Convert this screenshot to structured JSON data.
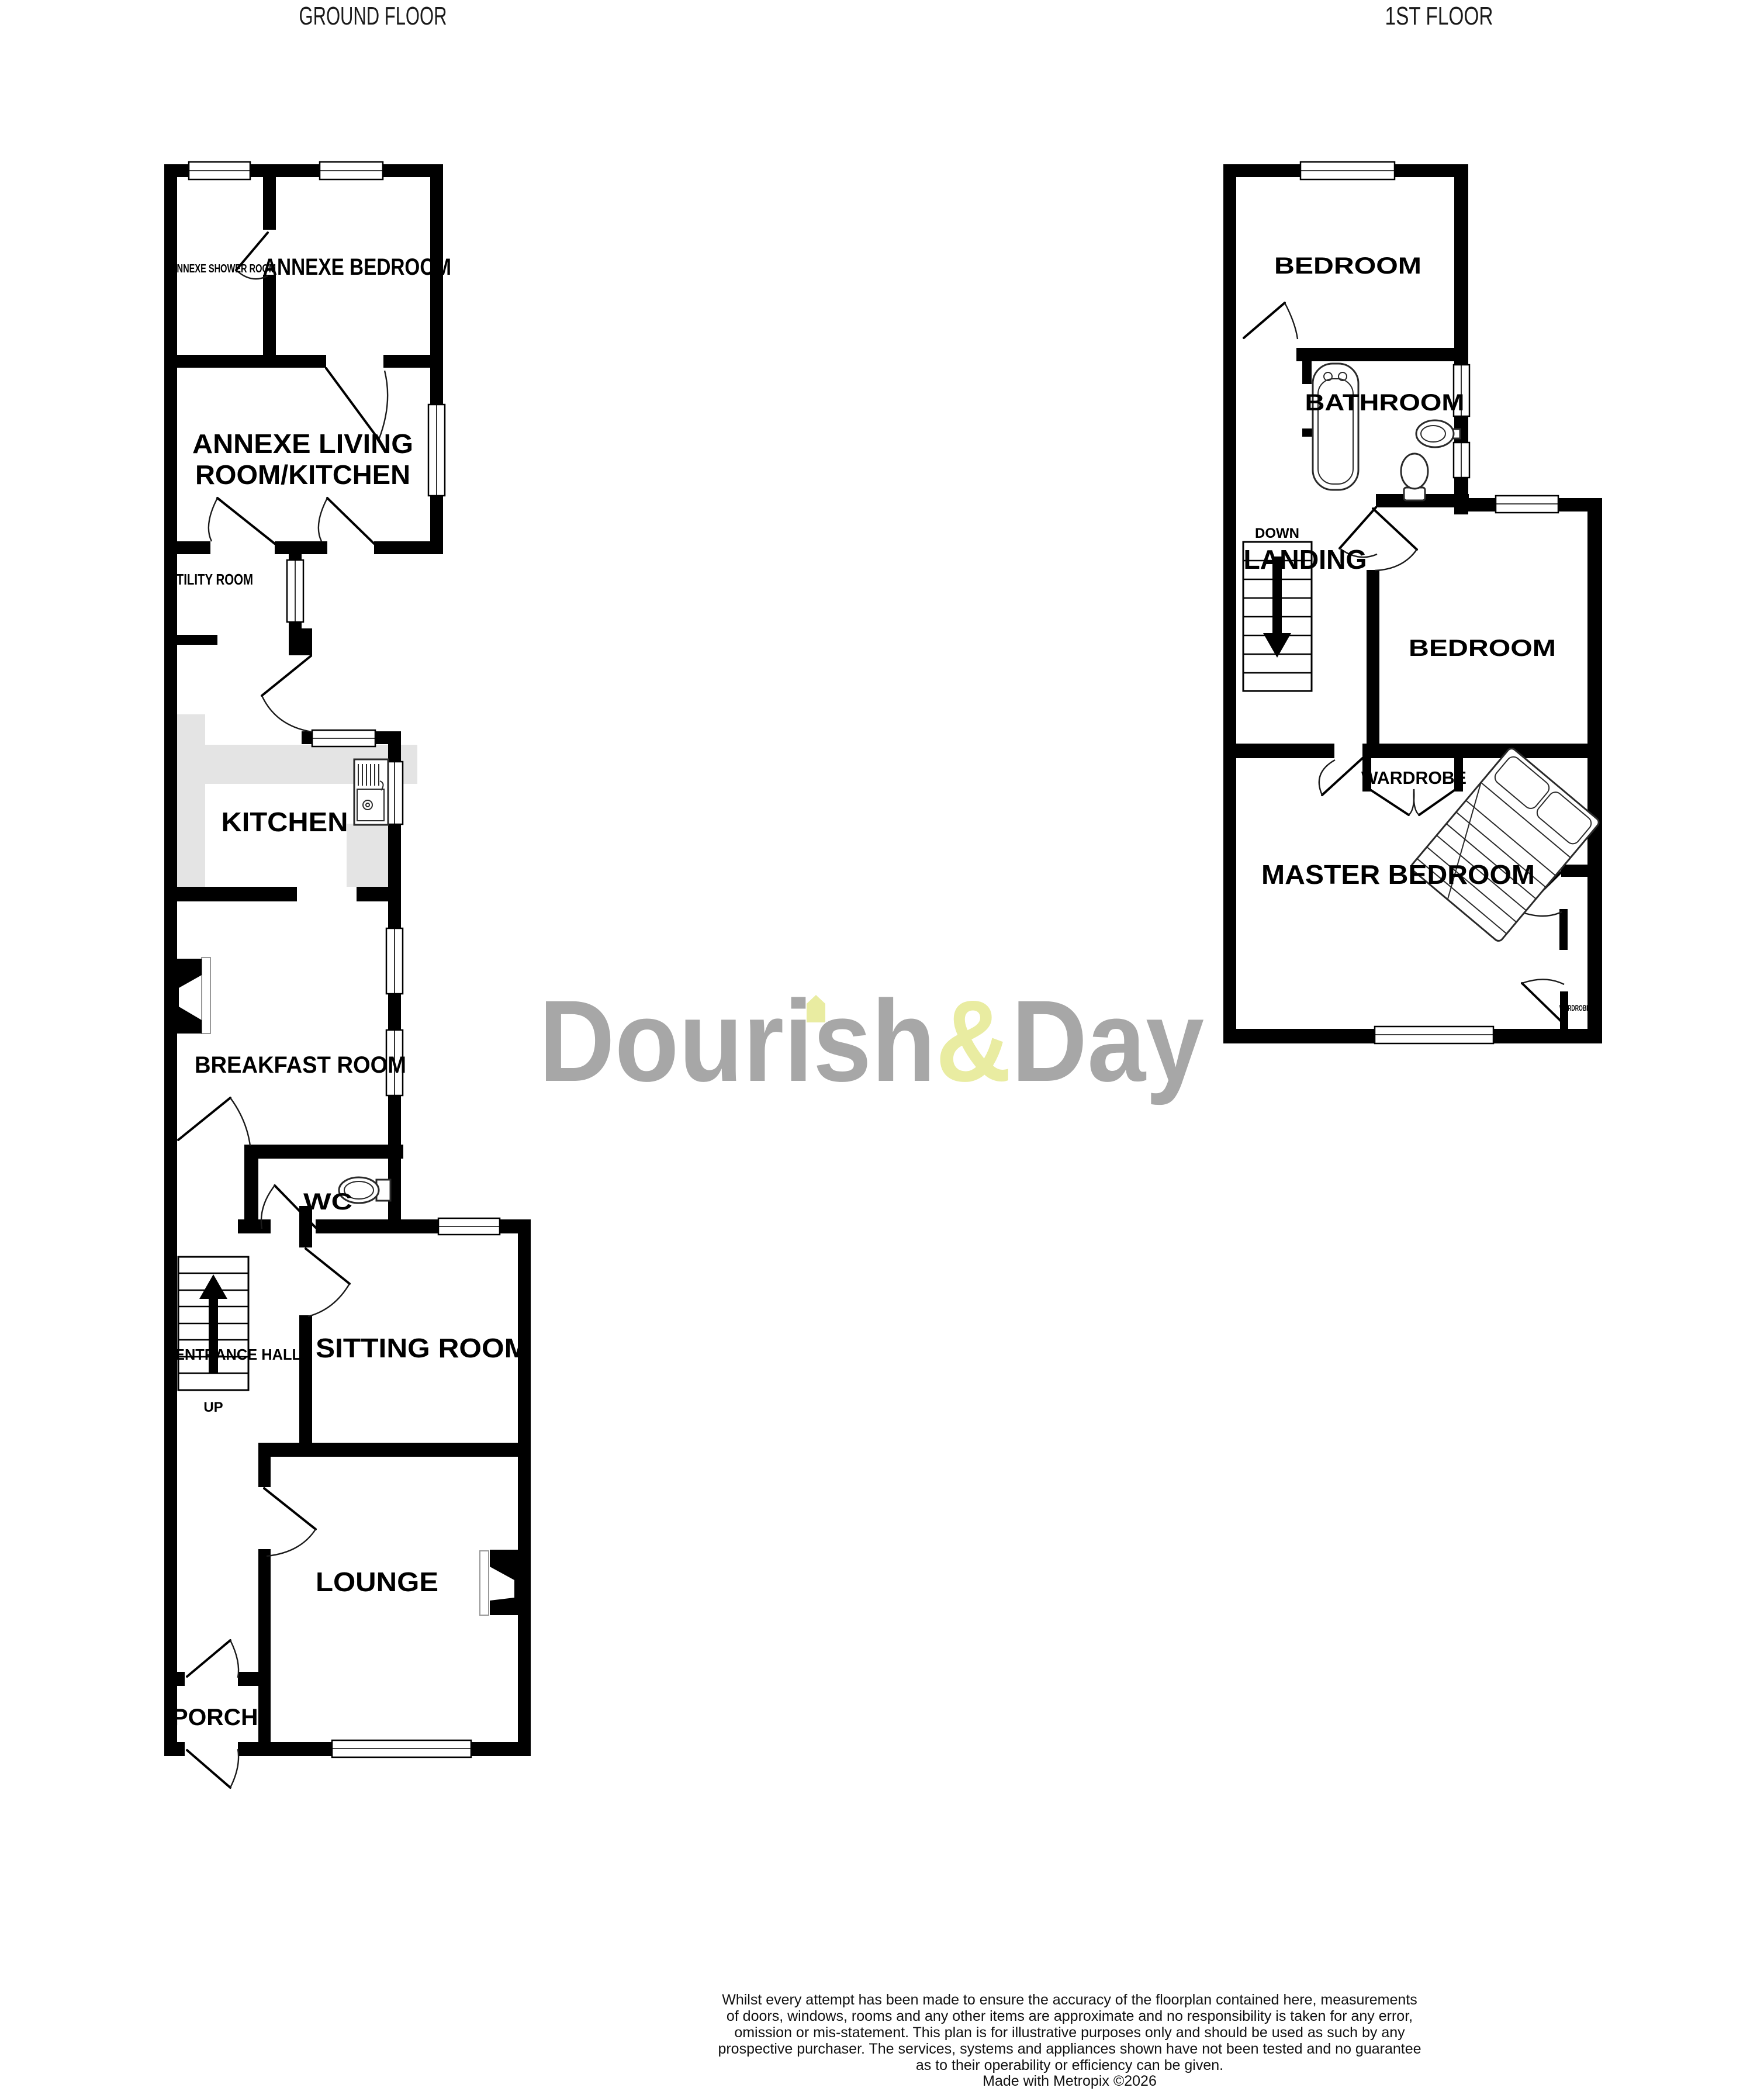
{
  "titles": {
    "ground": "GROUND FLOOR",
    "first": "1ST FLOOR"
  },
  "floors": {
    "ground": {
      "rooms": {
        "annexe_shower": "ANNEXE SHOWER ROOM",
        "annexe_bedroom": "ANNEXE BEDROOM",
        "annexe_living_line1": "ANNEXE LIVING",
        "annexe_living_line2": "ROOM/KITCHEN",
        "utility": "UTILITY ROOM",
        "kitchen": "KITCHEN",
        "breakfast": "BREAKFAST ROOM",
        "wc": "WC",
        "entrance_hall": "ENTRANCE HALL",
        "up": "UP",
        "sitting": "SITTING ROOM",
        "lounge": "LOUNGE",
        "porch": "PORCH"
      }
    },
    "first": {
      "rooms": {
        "bedroom_front": "BEDROOM",
        "bathroom": "BATHROOM",
        "down": "DOWN",
        "landing": "LANDING",
        "bedroom_middle": "BEDROOM",
        "wardrobe": "WARDROBE",
        "master_bedroom": "MASTER BEDROOM",
        "wardrobe_small": "WARDROBE"
      }
    }
  },
  "watermark": {
    "part1": "Dourish",
    "amp": "&",
    "part2": "Day",
    "gray": "#a7a7a7",
    "yellow": "#e9eca1"
  },
  "disclaimer": {
    "lines": [
      "Whilst every attempt has been made to ensure the accuracy of the floorplan contained here, measurements",
      "of doors, windows, rooms and any other items are approximate and no responsibility is taken for any error,",
      "omission or mis-statement. This plan is for illustrative purposes only and should be used as such by any",
      "prospective purchaser. The services, systems and appliances shown have not been tested and no guarantee",
      "as to their operability or efficiency can be given.",
      "Made with Metropix ©2026"
    ]
  },
  "colors": {
    "wall": "#000000",
    "counter": "#e4e4e4"
  }
}
